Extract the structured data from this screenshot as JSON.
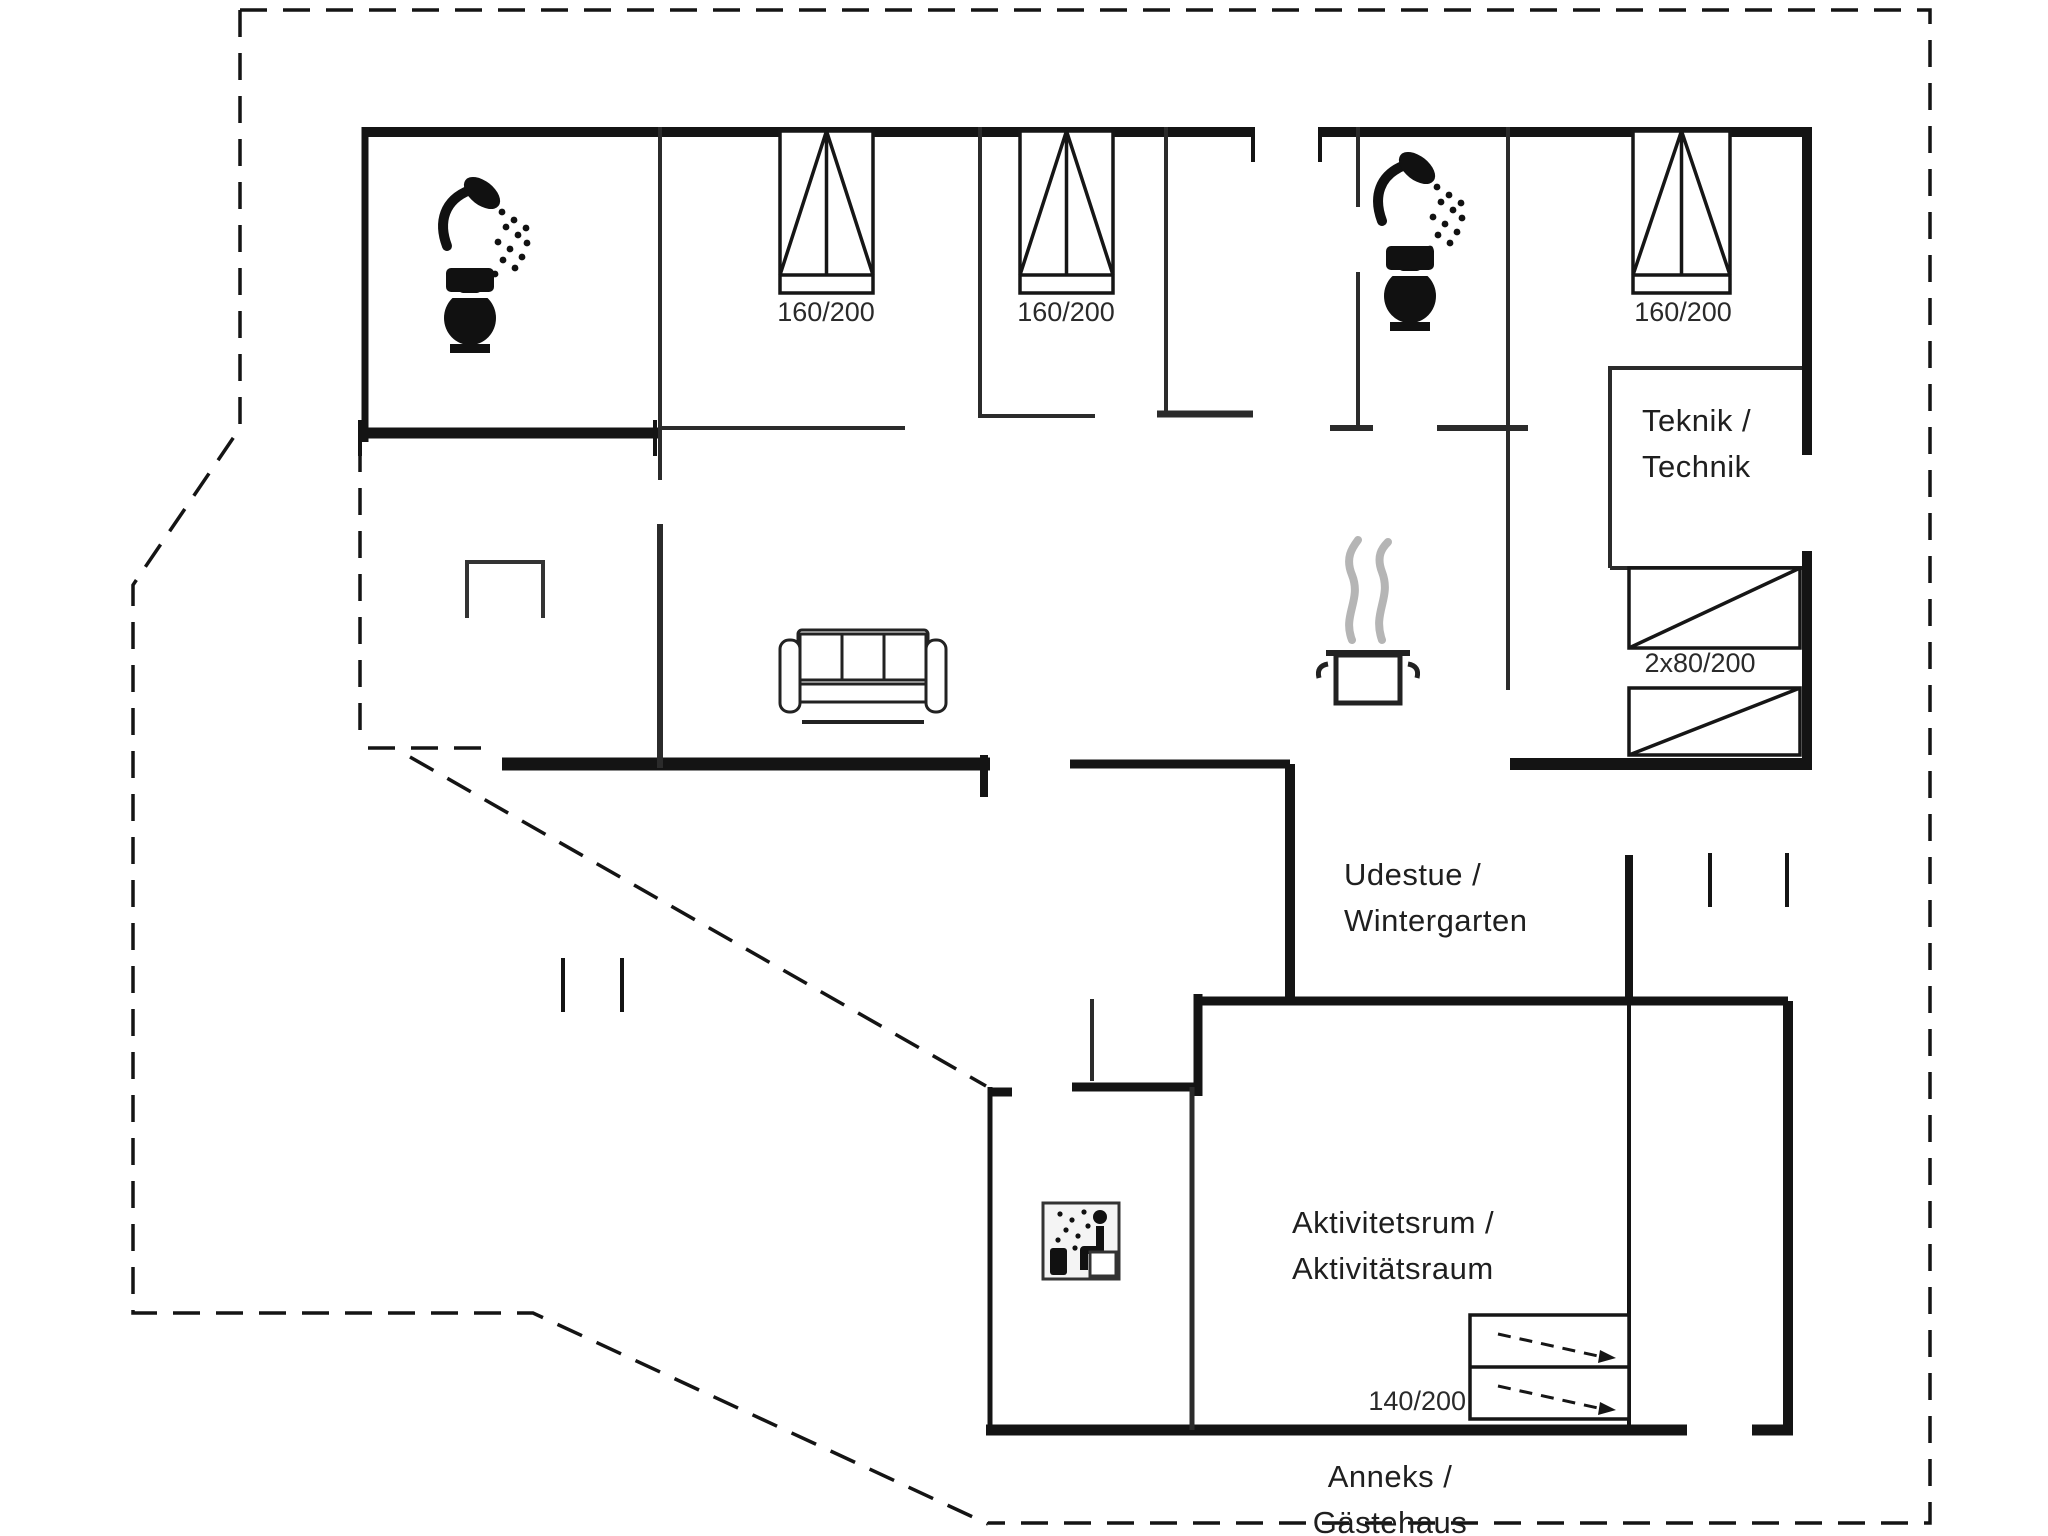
{
  "title": "Holiday house floor plan (Danish / German)",
  "rooms": {
    "teknik": {
      "line1": "Teknik /",
      "line2": "Technik"
    },
    "udestue": {
      "line1": "Udestue /",
      "line2": "Wintergarten"
    },
    "aktivitetsrum": {
      "line1": "Aktivitetsrum /",
      "line2": "Aktivitätsraum"
    },
    "anneks": {
      "line1": "Anneks /",
      "line2": "Gästehaus"
    }
  },
  "beds": {
    "bedroom1": "160/200",
    "bedroom2": "160/200",
    "bedroom3": "160/200",
    "bunk_room": "2x80/200",
    "annex_room": "140/200"
  },
  "icons": {
    "shower_icon_1": "shower head with spray (bathroom 1)",
    "toilet_icon_1": "toilet (bathroom 1)",
    "shower_icon_2": "shower head with spray (bathroom 2)",
    "toilet_icon_2": "toilet (bathroom 2)",
    "sofa_icon": "three-seat sofa (living room)",
    "stove_icon": "steaming cooking pot (kitchen)",
    "table_icon": "table on covered terrace",
    "sauna_icon": "sauna / person with steam (annex)"
  },
  "colors": {
    "wall": "#141414",
    "partition": "#2b2b2b",
    "steam": "#b5b5b5",
    "background": "#ffffff"
  }
}
